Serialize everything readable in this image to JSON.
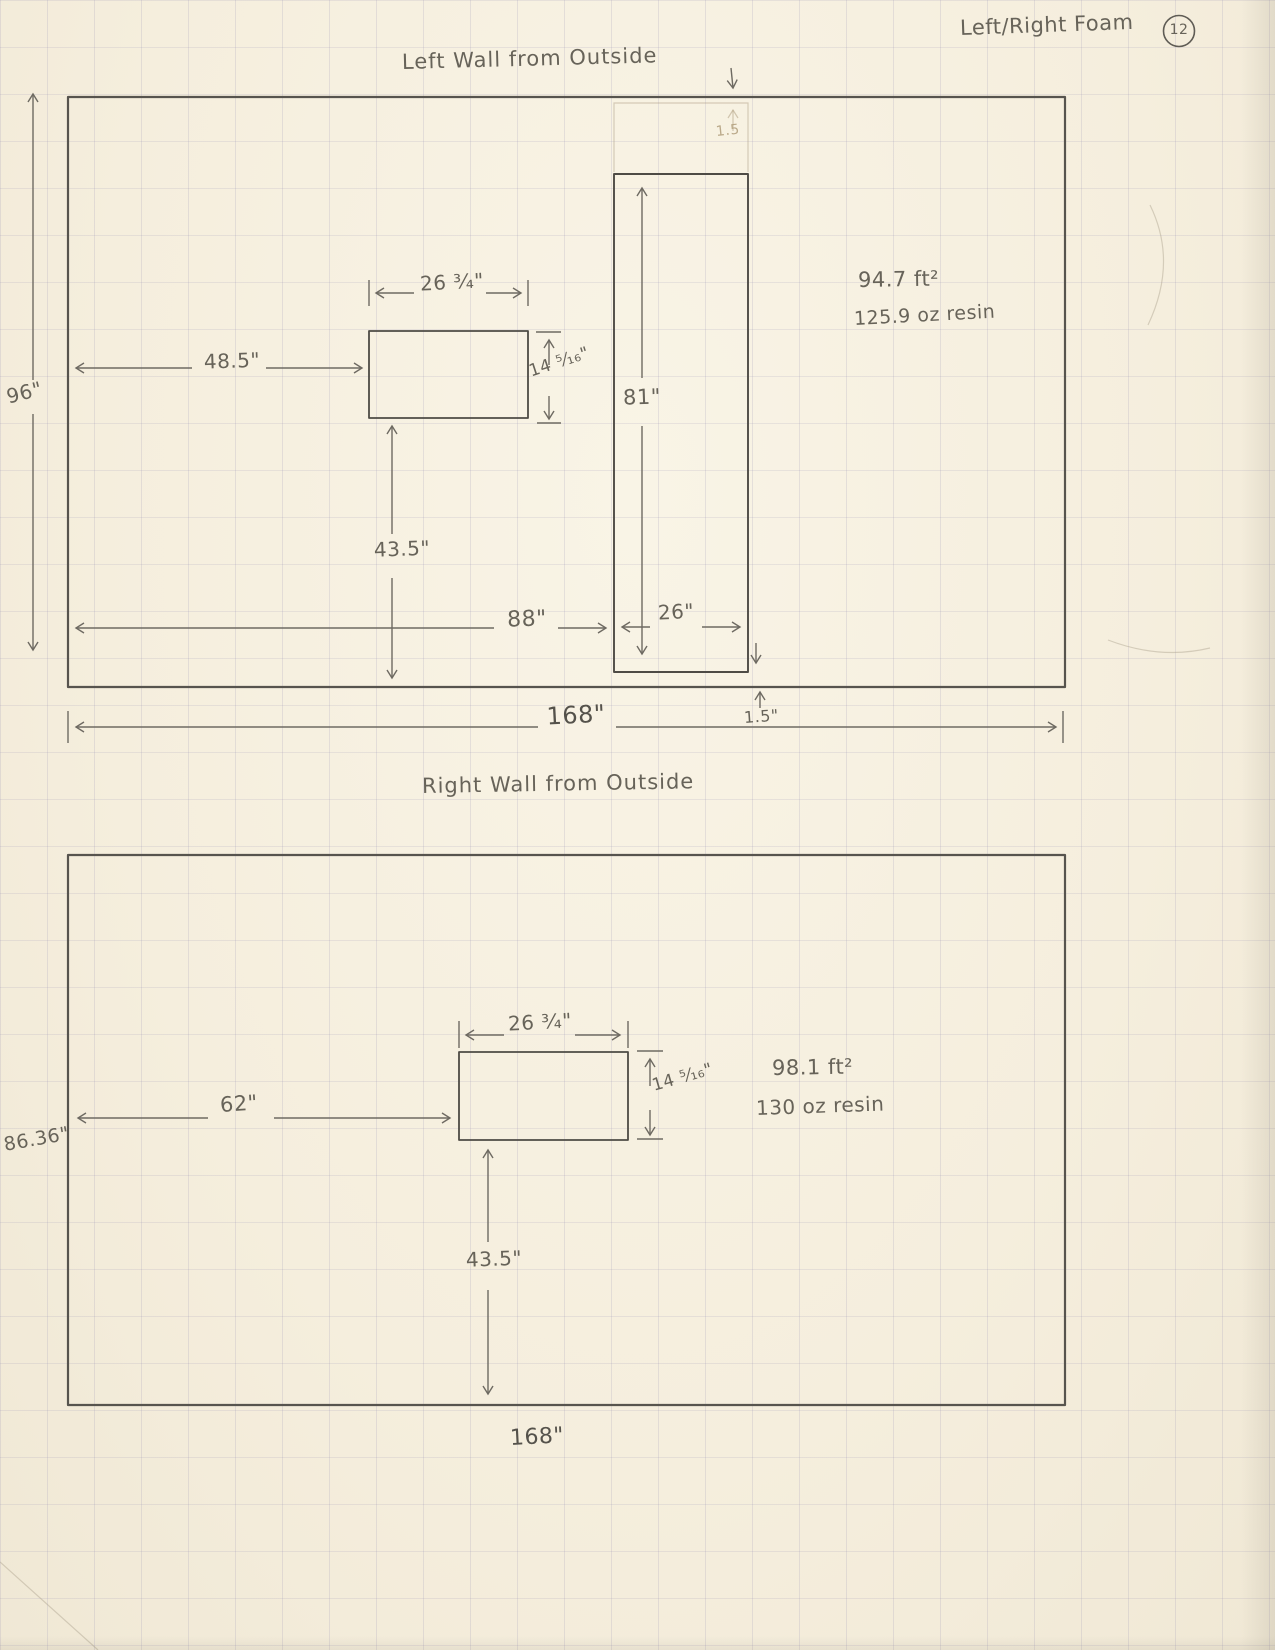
{
  "header": {
    "note": "Left/Right Foam",
    "page_number": "12"
  },
  "left_wall": {
    "title": "Left Wall from Outside",
    "wall_height": "96\"",
    "wall_width": "168\"",
    "window_width": "26 ³⁄₄\"",
    "window_height": "14 ⁵⁄₁₆\"",
    "window_offset_left": "48.5\"",
    "window_offset_bottom": "43.5\"",
    "door_height": "81\"",
    "door_width": "26\"",
    "door_offset_left": "88\"",
    "door_top_gap": "1.5",
    "door_bottom_gap": "1.5\"",
    "area": "94.7 ft²",
    "resin": "125.9 oz resin"
  },
  "right_wall": {
    "title": "Right Wall from Outside",
    "wall_height": "86.36\"",
    "wall_width": "168\"",
    "window_width": "26 ³⁄₄\"",
    "window_height": "14 ⁵⁄₁₆\"",
    "window_offset_left": "62\"",
    "window_offset_bottom": "43.5\"",
    "area": "98.1 ft²",
    "resin": "130 oz resin"
  }
}
